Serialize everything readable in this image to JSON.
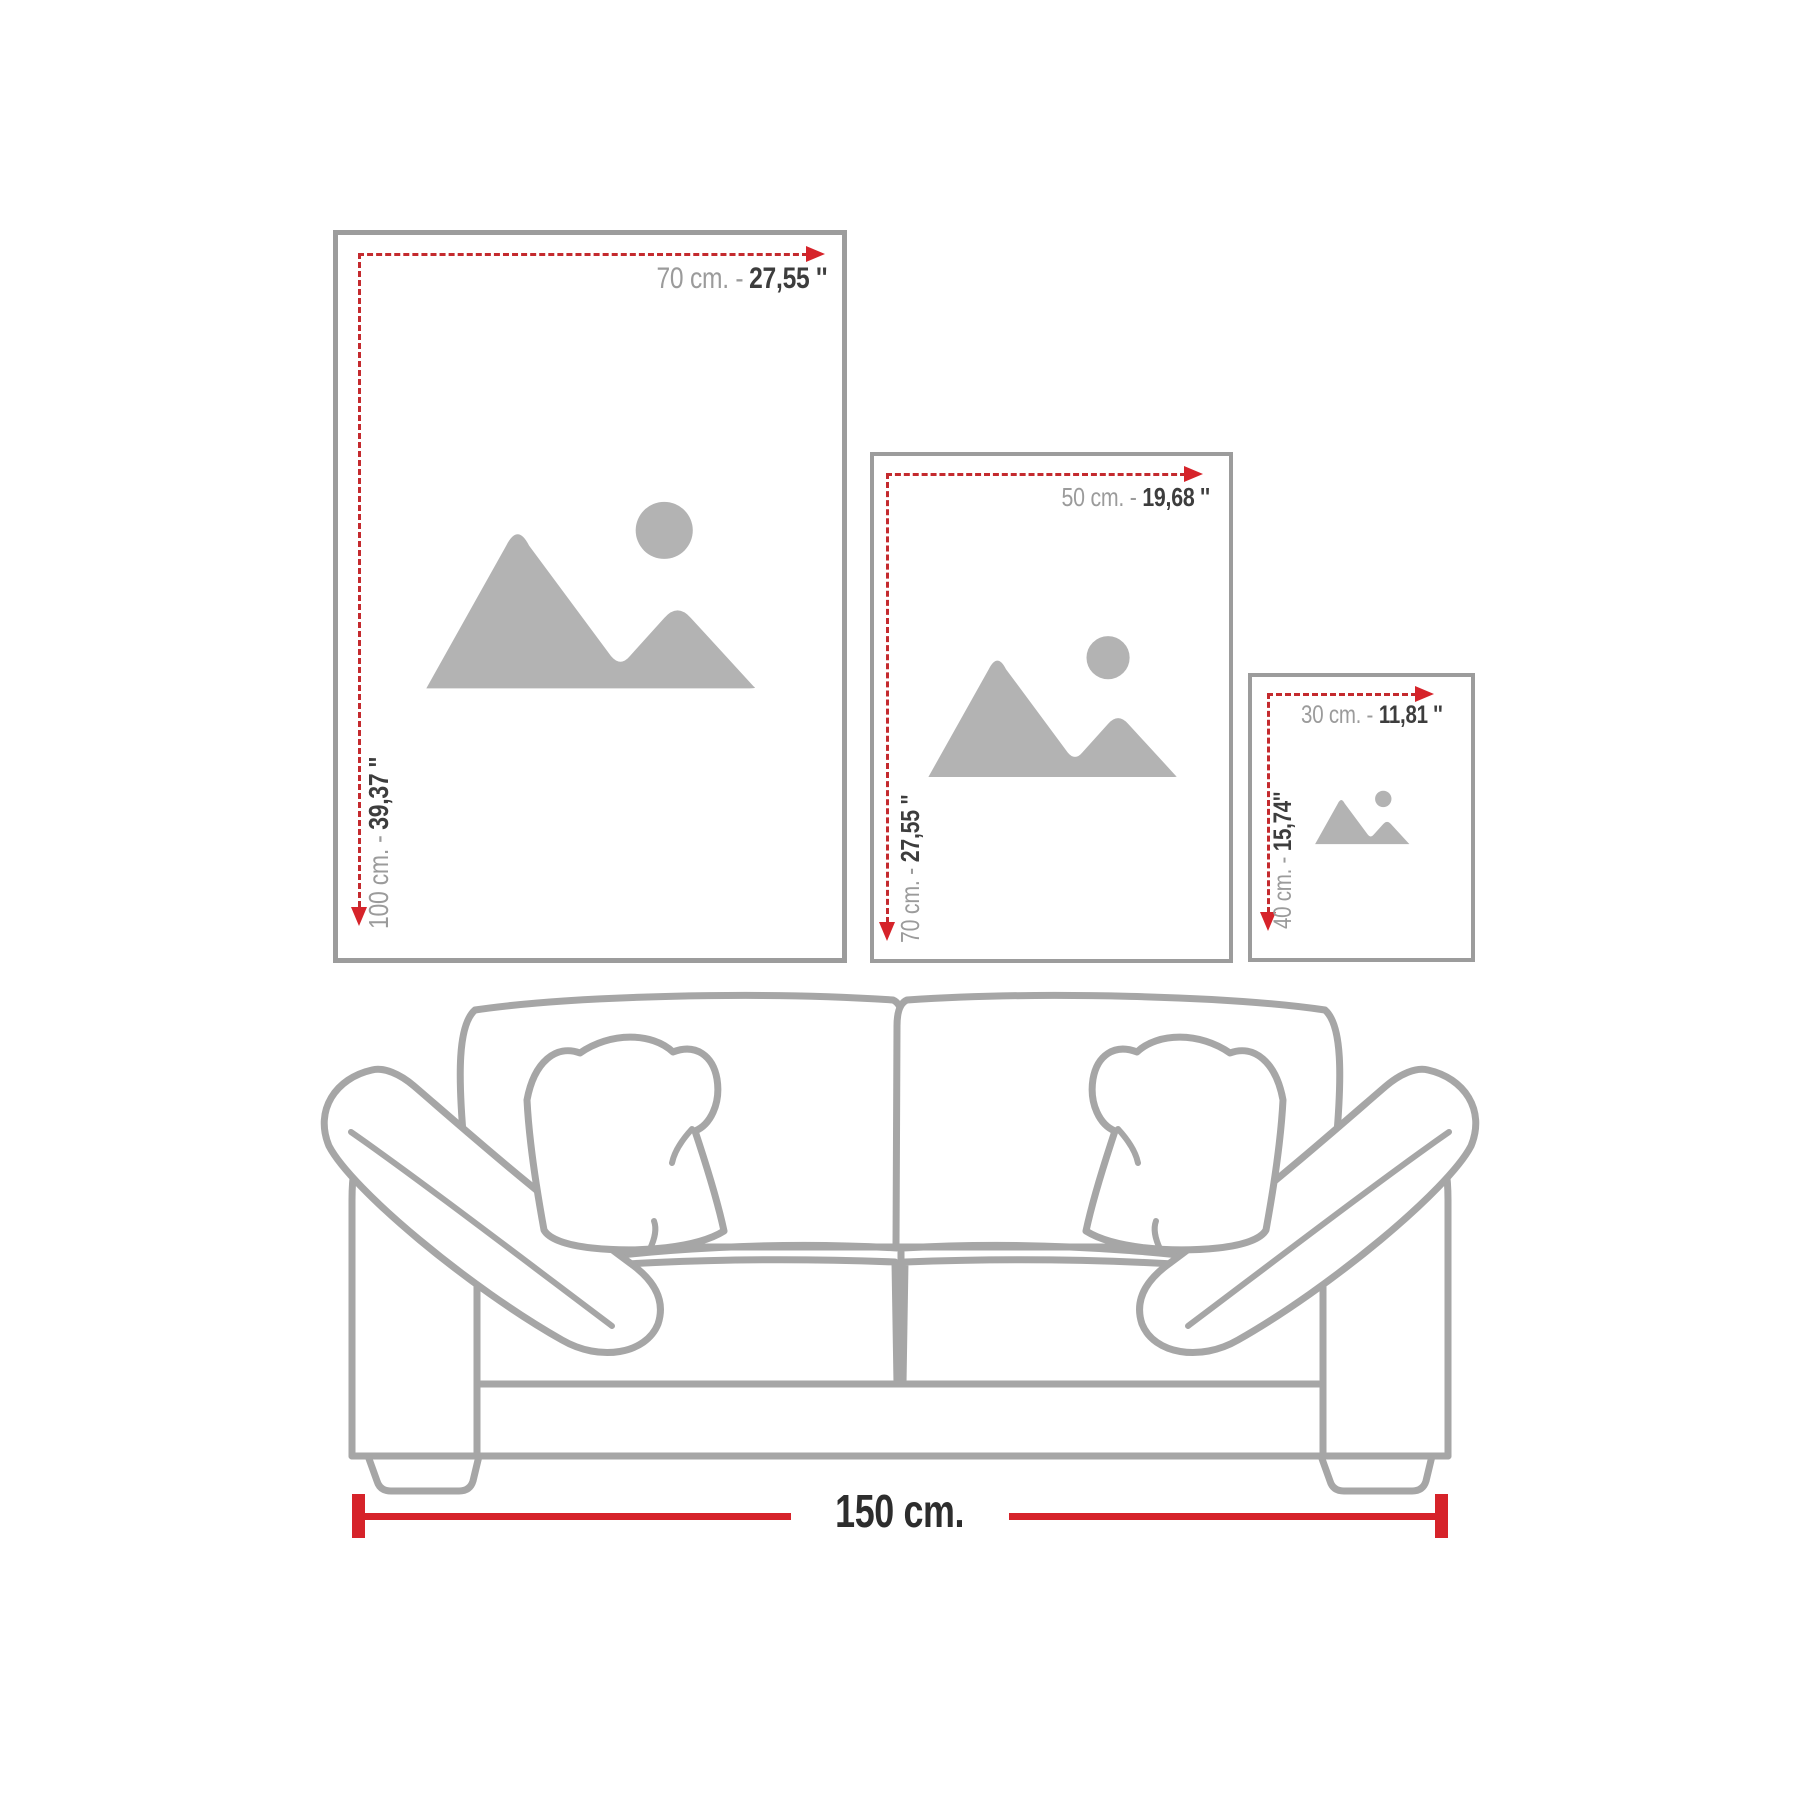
{
  "colors": {
    "red": "#d6232a",
    "red_dash": "#c42a2e",
    "frame_border": "#9c9c9c",
    "icon_gray": "#b3b3b3",
    "sofa_gray": "#a6a6a6",
    "text_gray": "#9b9b9b",
    "text_dark": "#3d3d3d",
    "label_dark": "#2d2d2d"
  },
  "frames": [
    {
      "id": "large",
      "icon": "mountains-sun-image-placeholder",
      "width_metric": "70 cm. -",
      "width_imperial": "27,55 ''",
      "height_metric": "100 cm. -",
      "height_imperial": "39,37 ''"
    },
    {
      "id": "medium",
      "icon": "mountains-sun-image-placeholder",
      "width_metric": "50 cm. -",
      "width_imperial": "19,68 ''",
      "height_metric": "70 cm. -",
      "height_imperial": "27,55 ''"
    },
    {
      "id": "small",
      "icon": "mountains-sun-image-placeholder",
      "width_metric": "30 cm. -",
      "width_imperial": "11,81 ''",
      "height_metric": "40 cm. -",
      "height_imperial": "15,74''"
    }
  ],
  "sofa": {
    "width_label": "150 cm."
  }
}
